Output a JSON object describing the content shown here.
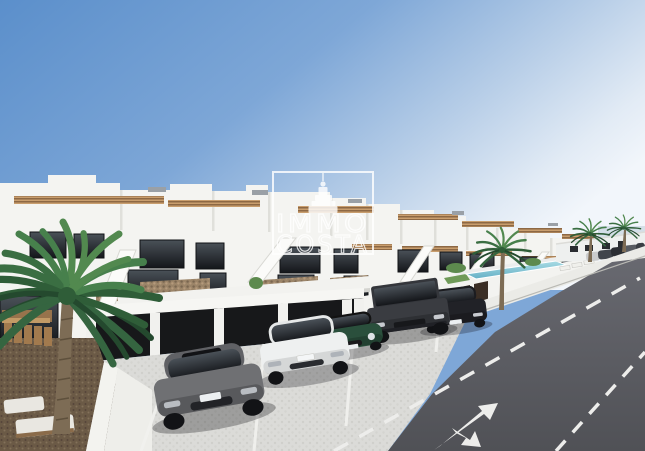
{
  "watermark": {
    "line1": "IMMO",
    "line2": "COSTA",
    "icon": "tower-logo-icon"
  },
  "scene": {
    "setting": "3D architectural render of a new development of white two-storey townhouses with stepped roof terraces, viewed in perspective from a street corner under a clear blue sky",
    "palette": {
      "sky_left": "#5b8fcb",
      "sky_right": "#f2f6fb",
      "building_white": "#f4f4f1",
      "building_shade": "#dcdcd7",
      "window_glass": "#1d2024",
      "wood_slat_railing": "#a87c52",
      "stone_gabion": "#9b8468",
      "garage_door": "#17181a",
      "parking_pavement": "#dbdbd8",
      "gravel_garden": "#6b5a46",
      "road_asphalt": "#5a5b60",
      "road_marking": "#ededeb",
      "pool_water": "#8ccbd9",
      "palm_green": "#3a6e42",
      "palm_trunk": "#7d6c55"
    },
    "vehicles": [
      {
        "name": "gray-sedan",
        "color": "#6f7073"
      },
      {
        "name": "white-sedan",
        "color": "#eef0f0"
      },
      {
        "name": "green-mini",
        "color": "#2a4f3c"
      },
      {
        "name": "dark-suv",
        "color": "#3a3c41"
      },
      {
        "name": "black-sedan",
        "color": "#212227"
      }
    ],
    "features": [
      "roof-terraces-with-wood-slat-railings",
      "external-white-staircases",
      "row-of-private-garages",
      "cobbled-parking-court-with-white-bays",
      "large-palm-tree-left",
      "palm-trees-right",
      "community-pool-behind-wall",
      "street-with-dashed-lane-lines",
      "turn-arrow-road-marking",
      "outdoor-dining-and-lounge-furniture",
      "gravel-garden-with-gabion-wall",
      "distant-parked-cars"
    ]
  }
}
